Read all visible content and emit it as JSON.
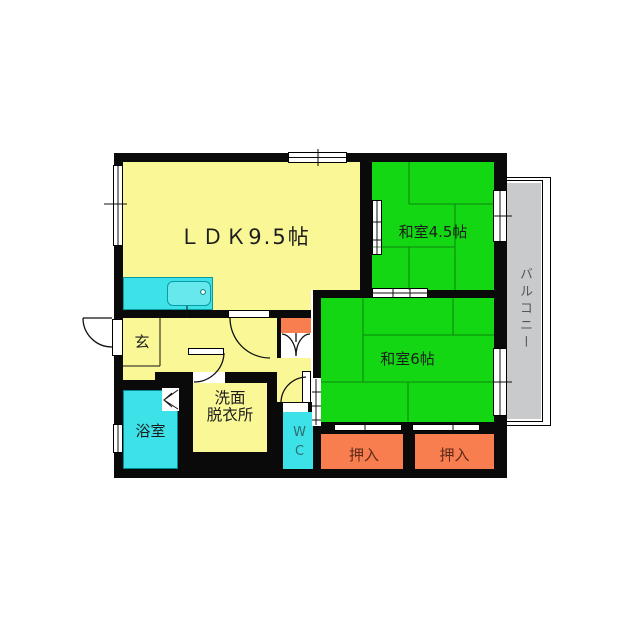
{
  "floorplan": {
    "rooms": {
      "ldk": "ＬＤＫ9.5帖",
      "japanese_room_45": "和室4.5帖",
      "japanese_room_6": "和室6帖",
      "balcony": "バルコニー",
      "entrance": "玄",
      "bathroom": "浴室",
      "washroom_line1": "洗面",
      "washroom_line2": "脱衣所",
      "toilet": "WC",
      "closet_left": "押入",
      "closet_right": "押入"
    },
    "colors": {
      "room_yellow": "#FAF896",
      "tatami_green": "#12D712",
      "closet_orange": "#F87E4F",
      "water_cyan": "#3CE2E8",
      "balcony_gray": "#C9CACB",
      "wall_black": "#0A0A0A",
      "closet_text": "#5D2A1C",
      "toilet_text": "#2F6D70",
      "balcony_text": "#555555"
    }
  }
}
